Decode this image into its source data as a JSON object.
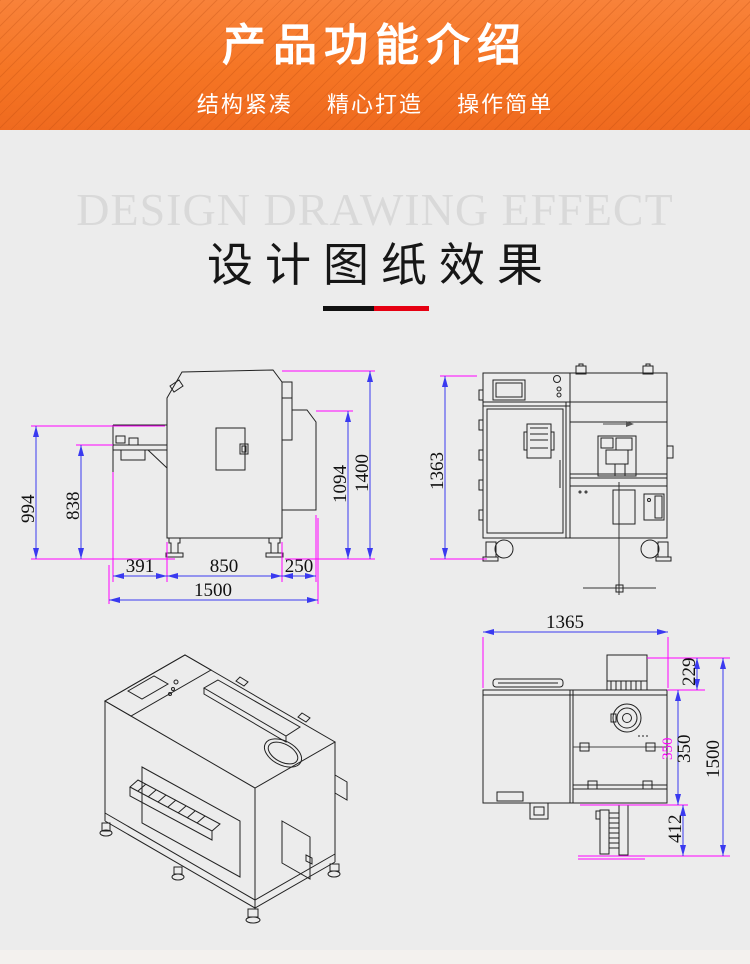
{
  "header": {
    "title": "产品功能介绍",
    "subtitles": [
      "结构紧凑",
      "精心打造",
      "操作简单"
    ]
  },
  "design_section": {
    "watermark": "DESIGN DRAWING EFFECT",
    "title": "设计图纸效果"
  },
  "drawings": {
    "side_view": {
      "dim_994": "994",
      "dim_838": "838",
      "dim_1094": "1094",
      "dim_1400": "1400",
      "dim_391": "391",
      "dim_850": "850",
      "dim_250": "250",
      "dim_1500": "1500"
    },
    "front_view": {
      "dim_1363": "1363"
    },
    "top_view": {
      "dim_1365": "1365",
      "dim_229": "229",
      "dim_350": "350",
      "dim_350_overlay": "350",
      "dim_412": "412",
      "dim_1500": "1500"
    }
  },
  "colors": {
    "accent_orange": "#f57524",
    "divider_black": "#111111",
    "divider_red": "#e60012",
    "dimension_line": "#3a3af0",
    "extension_line": "#ff00ff"
  }
}
